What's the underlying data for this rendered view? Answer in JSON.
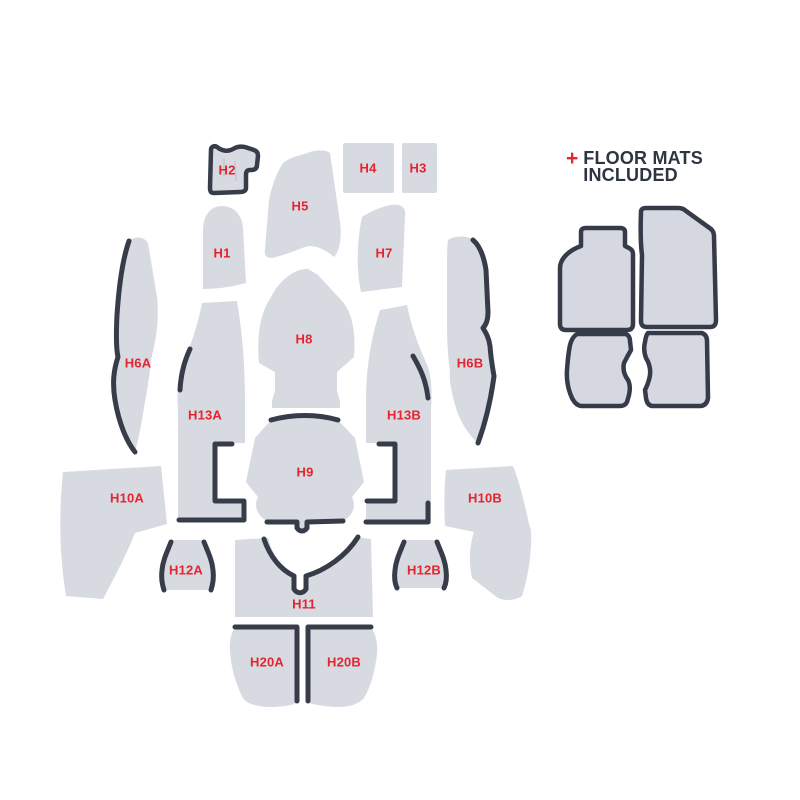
{
  "colors": {
    "background": "#ffffff",
    "piece_fill": "#d8dae2",
    "mat_fill": "#d6d8e1",
    "outline_dark": "#373c49",
    "label_red": "#e4242e",
    "heading_navy": "#2e3442"
  },
  "diagram": {
    "pieces": {
      "h1": "H1",
      "h2": "H2",
      "h3": "H3",
      "h4": "H4",
      "h5": "H5",
      "h6a": "H6A",
      "h6b": "H6B",
      "h7": "H7",
      "h8": "H8",
      "h9": "H9",
      "h10a": "H10A",
      "h10b": "H10B",
      "h11": "H11",
      "h12a": "H12A",
      "h12b": "H12B",
      "h13a": "H13A",
      "h13b": "H13B",
      "h20a": "H20A",
      "h20b": "H20B"
    }
  },
  "floor_mats": {
    "plus": "+",
    "heading_line1": "FLOOR MATS",
    "heading_line2": "INCLUDED",
    "mats": [
      "front-driver-mat",
      "front-passenger-mat",
      "rear-driver-mat",
      "rear-passenger-mat"
    ]
  }
}
